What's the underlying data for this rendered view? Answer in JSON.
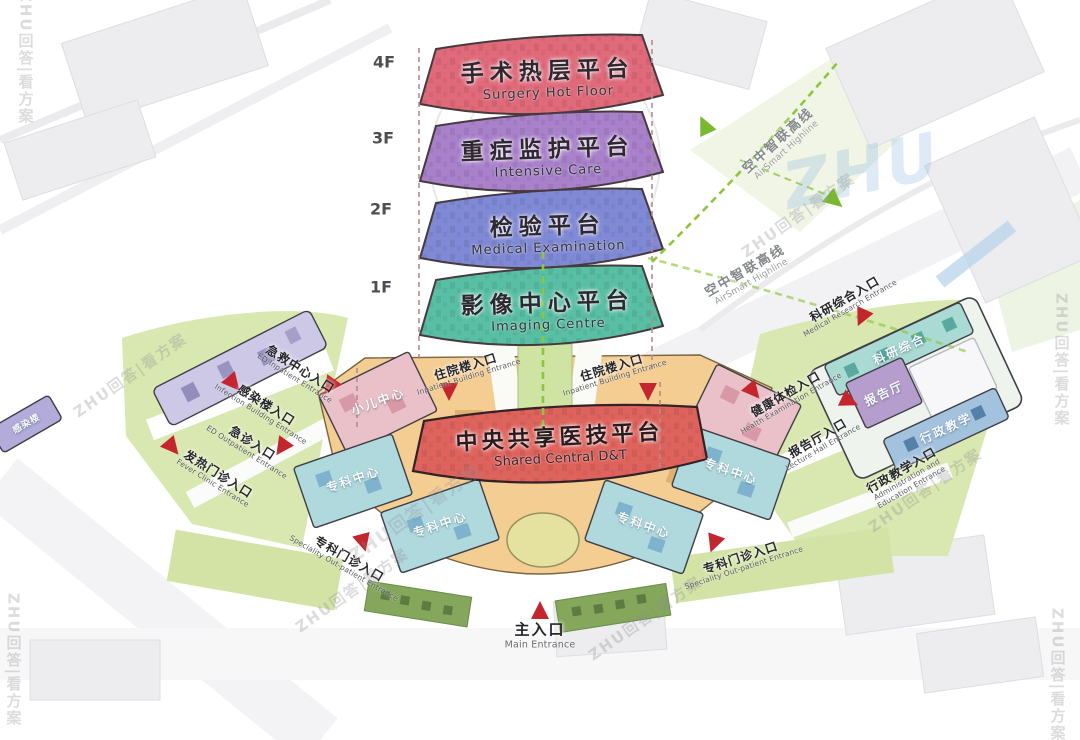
{
  "floors": [
    {
      "level": "4F",
      "zh": "手术热层平台",
      "en": "Surgery Hot Floor",
      "color": "#e0697a"
    },
    {
      "level": "3F",
      "zh": "重症监护平台",
      "en": "Intensive Care",
      "color": "#a981cb"
    },
    {
      "level": "2F",
      "zh": "检验平台",
      "en": "Medical Examination",
      "color": "#8089d5"
    },
    {
      "level": "1F",
      "zh": "影像中心平台",
      "en": "Imaging Centre",
      "color": "#58bfa4"
    }
  ],
  "central_platform": {
    "zh": "中央共享医技平台",
    "en": "Shared Central D&T",
    "color": "#df635d"
  },
  "highline": {
    "zh": "空中智联高线",
    "en": "AirSmart Highline",
    "color": "#8cc63e"
  },
  "entrances": {
    "ed_center": {
      "zh": "急救中心入口",
      "en": "ED Inpatient Entrance"
    },
    "infection": {
      "zh": "感染楼入口",
      "en": "Infection Building Entrance"
    },
    "ed_outpatient": {
      "zh": "急诊入口",
      "en": "ED Outpatient Entrance"
    },
    "fever": {
      "zh": "发热门诊入口",
      "en": "Fever Clinic Entrance"
    },
    "inpatient_left": {
      "zh": "住院楼入口",
      "en": "Inpatient Building Entrance"
    },
    "inpatient_right": {
      "zh": "住院楼入口",
      "en": "Inpatient Building Entrance"
    },
    "research": {
      "zh": "科研综合入口",
      "en": "Medical Research Entrance"
    },
    "health_exam": {
      "zh": "健康体检入口",
      "en": "Health Examination Entrance"
    },
    "lecture": {
      "zh": "报告厅入口",
      "en": "Lecture Hall Entrance"
    },
    "admin_edu": {
      "zh": "行政教学入口",
      "en": "Administration and Education Entrance"
    },
    "specialty_left": {
      "zh": "专科门诊入口",
      "en": "Speciality Out-patient Entrance"
    },
    "specialty_right": {
      "zh": "专科门诊入口",
      "en": "Speciality Out-patient Entrance"
    },
    "main": {
      "zh": "主入口",
      "en": "Main Entrance"
    }
  },
  "buildings": {
    "pediatric": "小儿中心",
    "specialty": "专科中心",
    "research_block": "科研综合",
    "lecture_hall": "报告厅",
    "admin_block": "行政教学",
    "infection_block": "感染楼"
  },
  "watermark": {
    "text": "ZHU回答|看方案",
    "logo": "ZHU"
  },
  "colors": {
    "arrow_red": "#c4262e",
    "podium": "#f3cd92",
    "lawn": "#d9e7b0",
    "teal_block": "#b0d9de",
    "pink_block": "#eac0c9",
    "lavender_block": "#ccc8e6"
  }
}
